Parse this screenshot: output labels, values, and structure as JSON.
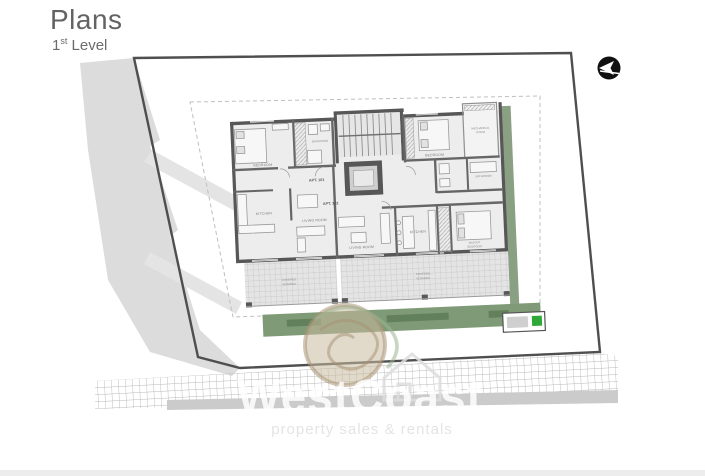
{
  "header": {
    "title": "Plans",
    "level_num": "1",
    "level_ord": "st",
    "level_word": "Level"
  },
  "compass": {
    "meaning": "north-arrow"
  },
  "watermark": {
    "brand": "WestCoast",
    "tagline": "property sales & rentals"
  },
  "plan": {
    "apt101": {
      "id": "APT. 101",
      "bedroom": "BEDROOM",
      "bathroom": "BATHROOM",
      "kitchen": "KITCHEN",
      "living": "LIVING ROOM",
      "veranda_l1": "COVERED",
      "veranda_l2": "VERANDA"
    },
    "apt102": {
      "id": "APT. 102",
      "bedroom": "BEDROOM",
      "bathroom": "BATHROOM",
      "kitchen": "KITCHEN",
      "living": "LIVING ROOM",
      "master_l1": "MASTER",
      "master_l2": "BEDROOM",
      "veranda_l1": "COVERED",
      "veranda_l2": "VERANDA"
    },
    "mechanical_l1": "MECHANICAL",
    "mechanical_l2": "ROOM"
  },
  "colors": {
    "wall": "#575757",
    "site_boundary": "#4f4f4f",
    "garden_green": "#7f9a77",
    "hedge_green": "#5e7b57",
    "utility_green": "#2ea836",
    "neighbor_gray": "#dcdcdc"
  }
}
